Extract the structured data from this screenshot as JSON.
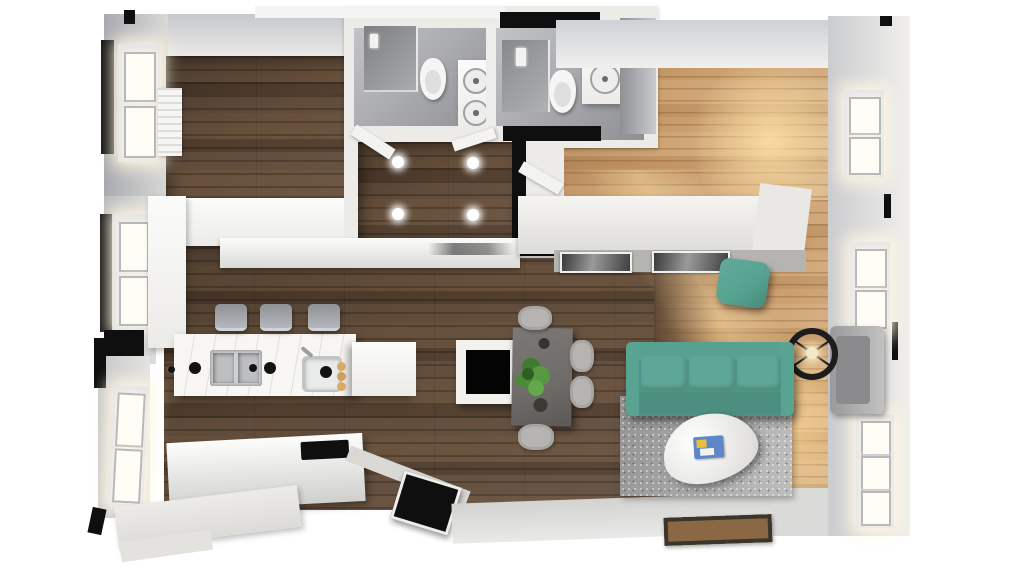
{
  "scene": {
    "type": "3d-floorplan-top-view",
    "width_px": 1024,
    "height_px": 576
  },
  "palette": {
    "bg": "#ffffff",
    "wall_white": "#ecebe8",
    "wall_gray": "#b9babd",
    "ceiling_gray": "#ced1d5",
    "wall_black": "#0f0f0f",
    "wood_dark": "#5b4533",
    "wood_light": "#c79a69",
    "sunlight": "#ffdfa8",
    "tile_gray": "#a6a7ab",
    "fixture_white": "#f5f5f3",
    "steel_gray": "#9ba0a6",
    "sofa_teal": "#5ea796",
    "sofa_teal_deep": "#4f9383",
    "pouf_teal": "#55a18f",
    "rug_gray": "#a9a9a9",
    "marble_white": "#f7f6f3",
    "dining_table_gray": "#6f6b69",
    "chair_gray": "#b6b4b0",
    "plant_green": "#4e8c38",
    "lamp_black": "#1d1d1d",
    "doormat_brown": "#8a6843",
    "art_dark": "#3f3f3f",
    "magazine_blue": "#5f86c9",
    "magazine_yellow": "#e7c13b"
  },
  "rooms": [
    {
      "id": "bedroom",
      "label": "Bedroom"
    },
    {
      "id": "bathroom-1",
      "label": "Bathroom 1"
    },
    {
      "id": "bathroom-2",
      "label": "Bathroom 2"
    },
    {
      "id": "hallway",
      "label": "Hallway"
    },
    {
      "id": "kitchen-dining",
      "label": "Kitchen / Dining"
    },
    {
      "id": "living-room",
      "label": "Living Room"
    }
  ],
  "labels": {
    "bedroom": "Bedroom",
    "bathroom1": "Bathroom 1",
    "bathroom2": "Bathroom 2",
    "hallway": "Hallway",
    "kitchen": "Kitchen / Dining",
    "living": "Living Room",
    "sofa": "Teal 3-seat sofa",
    "rug": "Gray area rug",
    "coffee_table": "White pebble coffee table",
    "magazines": "Magazines on tray",
    "floor_lamp": "Black arc floor lamp",
    "pouf": "Teal pouf",
    "armchair": "Gray armchair",
    "sideboard": "White sideboard",
    "artwork": "Framed artwork",
    "dining_table": "Gray dining table",
    "dining_chair": "Dining chair",
    "plant": "Potted green plant",
    "tv_table": "White side table with black top",
    "doormat": "Entry doormat",
    "island": "Kitchen island with marble top",
    "bar_stool": "Bar stool",
    "double_sink": "Double kitchen sink",
    "prep_sink": "Prep sink with faucet",
    "knob": "Cooktop knob / burner",
    "pastries": "Plate of pastries",
    "island_cabinet": "Island end cabinet",
    "base_counter": "Base cabinet with cooktop",
    "cooktop": "Black cooktop",
    "wall_counter": "Kitchen wall counter",
    "column_cabinet": "Tall cabinet column",
    "wardrobe": "White wardrobe",
    "window": "Window",
    "radiator": "Radiator",
    "toilet": "Toilet",
    "shower": "Walk-in shower",
    "vanity": "Vanity with sink",
    "spotlight": "Ceiling spotlight",
    "entry_door": "Entry door",
    "interior_door": "Interior door",
    "mirror_cabinet": "Mirrored bathroom wall"
  }
}
